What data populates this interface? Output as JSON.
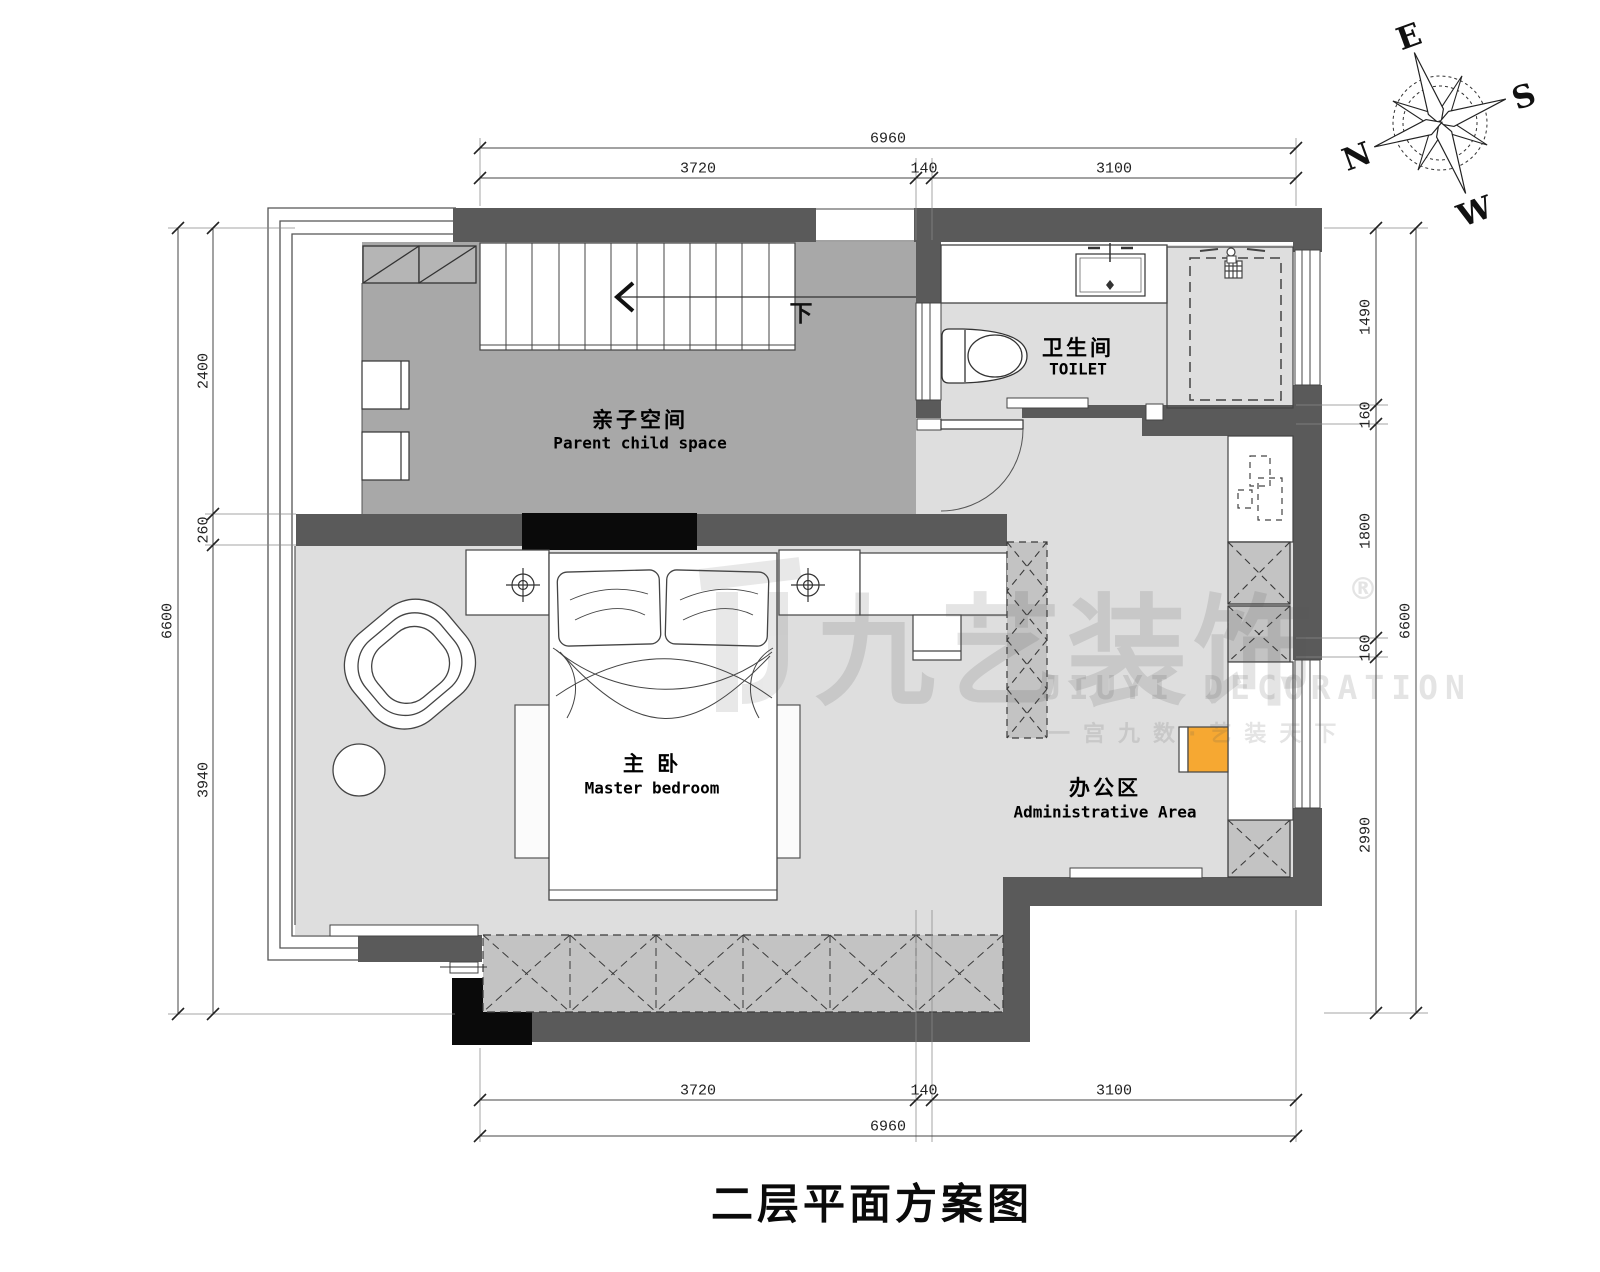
{
  "page_title": "二层平面方案图",
  "compass": {
    "e": "E",
    "s": "S",
    "n": "N",
    "w": "W"
  },
  "rooms": {
    "parent_child": {
      "zh": "亲子空间",
      "en": "Parent child space"
    },
    "toilet": {
      "zh": "卫生间",
      "en": "TOILET"
    },
    "master_bedroom": {
      "zh": "主 卧",
      "en": "Master bedroom"
    },
    "office": {
      "zh": "办公区",
      "en": "Administrative Area"
    }
  },
  "stairs": {
    "down_label": "下"
  },
  "dimensions": {
    "top": {
      "total": "6960",
      "s1": "3720",
      "s2": "140",
      "s3": "3100"
    },
    "bottom": {
      "total": "6960",
      "s1": "3720",
      "s2": "140",
      "s3": "3100"
    },
    "left": {
      "total": "6600",
      "s1": "2400",
      "s2": "260",
      "s3": "3940"
    },
    "right": {
      "total": "6600",
      "s1": "1490",
      "s2": "160",
      "s3": "1800",
      "s4": "160",
      "s5": "2990"
    }
  },
  "watermark": {
    "brand": "九艺装饰",
    "reg": "®",
    "brand_en": "JIUYI DECORATION",
    "tagline": "一宫九数·艺装天下"
  },
  "colors": {
    "wall": "#5a5a5a",
    "floor_dark": "#a8a8a8",
    "floor_light": "#dedede",
    "hatch": "#c3c3c3",
    "accent_orange": "#f6a832",
    "black": "#0a0a0a"
  }
}
